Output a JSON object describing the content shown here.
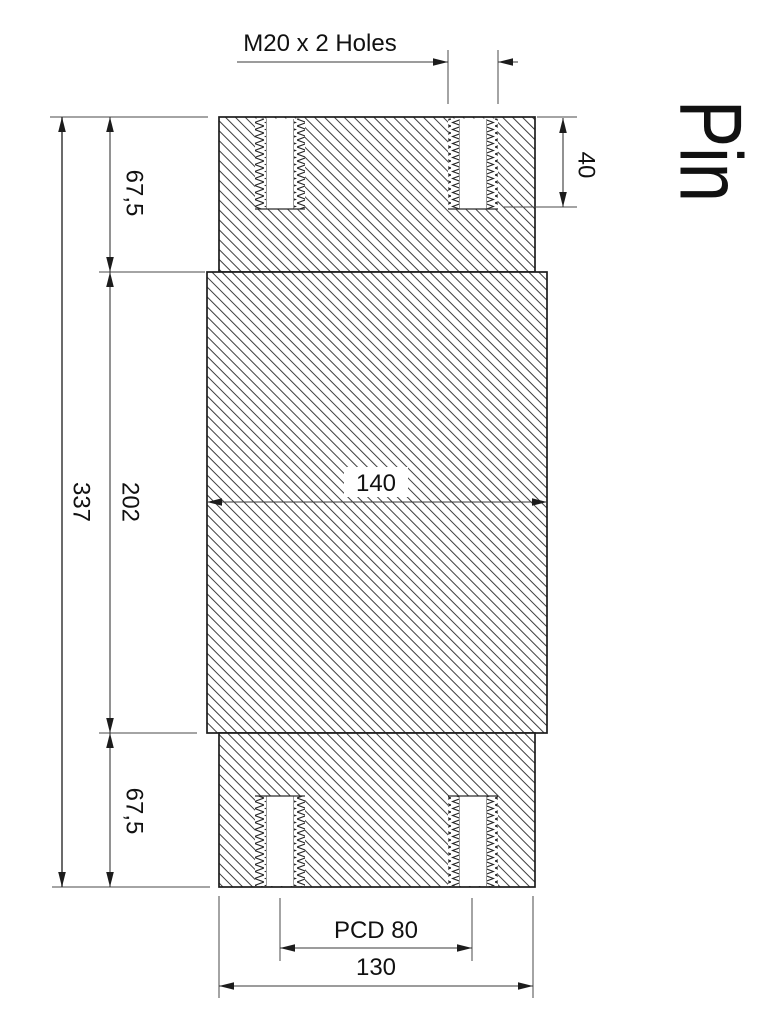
{
  "title": {
    "text": "Pin"
  },
  "callouts": {
    "thread_spec": "M20 x 2 Holes"
  },
  "dimensions": {
    "hole_depth": "40",
    "top_section_length": "67,5",
    "middle_section_length": "202",
    "total_length": "337",
    "bottom_section_length": "67,5",
    "middle_diameter": "140",
    "pitch_circle_diameter": "PCD 80",
    "end_diameter": "130"
  },
  "colors": {
    "background": "#ffffff",
    "outline": "#1c1c1c",
    "hatch": "#3e3e3e",
    "dimension_line": "#3a3a3a",
    "extension_line": "#4a4a4a",
    "text": "#111111"
  }
}
